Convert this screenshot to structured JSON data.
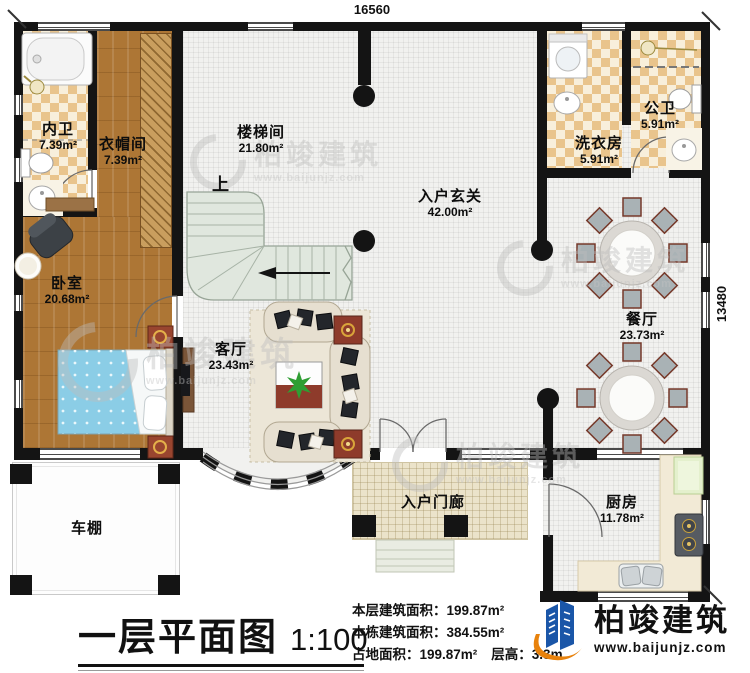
{
  "dimensions": {
    "width": "16560",
    "height": "13480"
  },
  "stairs": {
    "up_label": "上"
  },
  "rooms": [
    {
      "name": "内卫",
      "area": "7.39m²"
    },
    {
      "name": "衣帽间",
      "area": "7.39m²"
    },
    {
      "name": "楼梯间",
      "area": "21.80m²"
    },
    {
      "name": "入户玄关",
      "area": "42.00m²"
    },
    {
      "name": "洗衣房",
      "area": "5.91m²"
    },
    {
      "name": "公卫",
      "area": "5.91m²"
    },
    {
      "name": "卧室",
      "area": "20.68m²"
    },
    {
      "name": "客厅",
      "area": "23.43m²"
    },
    {
      "name": "餐厅",
      "area": "23.73m²"
    },
    {
      "name": "厨房",
      "area": "11.78m²"
    },
    {
      "name": "入户门廊",
      "area": ""
    },
    {
      "name": "车棚",
      "area": ""
    }
  ],
  "title": {
    "text": "一层平面图",
    "scale": "1:100"
  },
  "stats": {
    "line1_label": "本层建筑面积：",
    "line1_value": "199.87m²",
    "line2_label": "本栋建筑面积：",
    "line2_value": "384.55m²",
    "line3_label": "占地面积：",
    "line3_value": "199.87m²",
    "line4_label": "层高：",
    "line4_value": "3.3m"
  },
  "brand": {
    "name": "柏竣建筑",
    "site": "www.baijunjz.com"
  },
  "colors": {
    "wall": "#141414",
    "accent_blue": "#1a56a8",
    "accent_orange": "#e8820c",
    "stair_green": "#e0e7de",
    "checker_tan": "#e9c48c"
  }
}
